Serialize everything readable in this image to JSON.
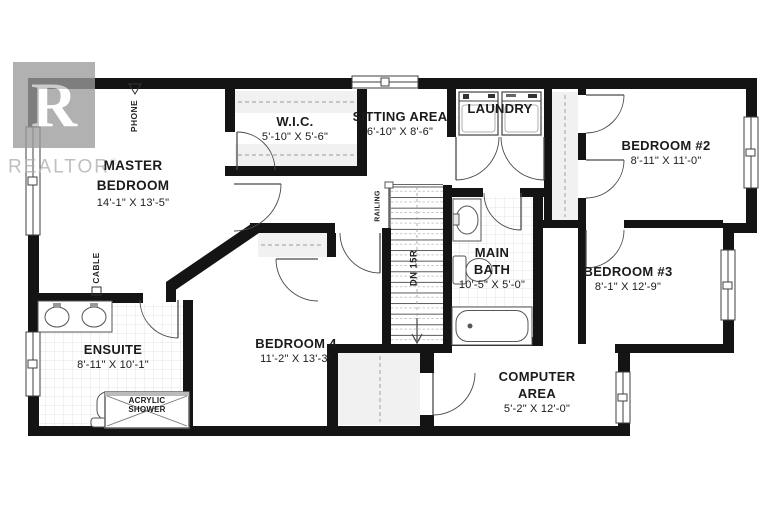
{
  "colors": {
    "wall": "#141414",
    "watermark_gray": "#9c9c9c",
    "tile_line": "#dcdcdc"
  },
  "watermark": {
    "logo_letter": "R",
    "brand": "REALTOR",
    "registered": "®"
  },
  "rooms": {
    "master": {
      "line1": "MASTER",
      "line2": "BEDROOM",
      "dims": "14'-1\" X 13'-5\""
    },
    "wic": {
      "line1": "W.I.C.",
      "dims": "5'-10\" X 5'-6\""
    },
    "sitting": {
      "line1": "SITTING AREA",
      "dims": "6'-10\" X 8'-6\""
    },
    "laundry": {
      "line1": "LAUNDRY"
    },
    "bedroom2": {
      "line1": "BEDROOM #2",
      "dims": "8'-11\" X 11'-0\""
    },
    "bedroom3": {
      "line1": "BEDROOM #3",
      "dims": "8'-1\" X 12'-9\""
    },
    "mainbath": {
      "line1": "MAIN",
      "line2": "BATH",
      "dims": "10'-5\" X 5'-0\""
    },
    "bedroom4": {
      "line1": "BEDROOM 4",
      "dims": "11'-2\" X 13'-3\""
    },
    "ensuite": {
      "line1": "ENSUITE",
      "dims": "8'-11\" X 10'-1\""
    },
    "computer": {
      "line1": "COMPUTER",
      "line2": "AREA",
      "dims": "5'-2\" X 12'-0\""
    },
    "shower": {
      "line1": "ACRYLIC",
      "line2": "SHOWER"
    }
  },
  "annotations": {
    "phone": "PHONE",
    "cable": "CABLE",
    "railing": "RAILING",
    "stairs_direction": "DN 15R"
  }
}
